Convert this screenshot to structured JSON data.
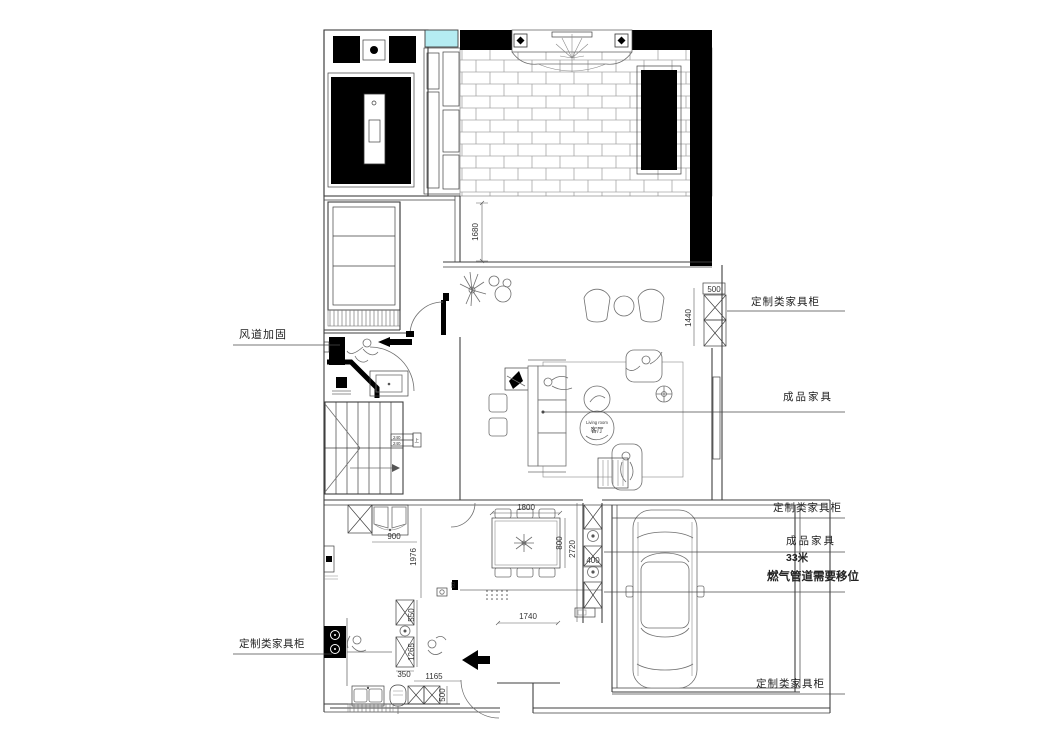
{
  "page": {
    "background": "#ffffff"
  },
  "colors": {
    "line": "#3f3f3f",
    "furniture_line": "#6f6f6f",
    "black_fill": "#000000",
    "brick_line": "#a6a6a6",
    "window_cyan": "#b5ecf2"
  },
  "room_circle": {
    "name_en": "Living room",
    "name_cn": "客厅"
  },
  "callouts": {
    "duct_reinforce": "风道加固",
    "custom_cabinet_top_right": "定制类家具柜",
    "finished_furniture_mid": "成品家具",
    "custom_cabinet_right": "定制类家具柜",
    "finished_furniture_right": "成品家具",
    "meters_33": "33米",
    "gas_pipe_note": "燃气管道需要移位",
    "custom_cabinet_bottom_right": "定制类家具柜",
    "custom_cabinet_bottom_left": "定制类家具柜"
  },
  "dimensions": {
    "terrace_depth": "1680",
    "cabinet_width": "500",
    "cabinet_height": "1440",
    "fridge_run": "900",
    "kitchen_run": "1976",
    "dining_table_w": "1800",
    "dining_table_d": "800",
    "dining_room_d": "2720",
    "column_w": "400",
    "upper_cab": "550",
    "tall_cab": "1265",
    "base_cab": "350",
    "entry_opening": "1165",
    "entry_cab_d": "500",
    "hall_w": "1740",
    "door_frame": "60"
  },
  "stair_tag": {
    "row1": "240",
    "row2": "240",
    "side": "上"
  }
}
